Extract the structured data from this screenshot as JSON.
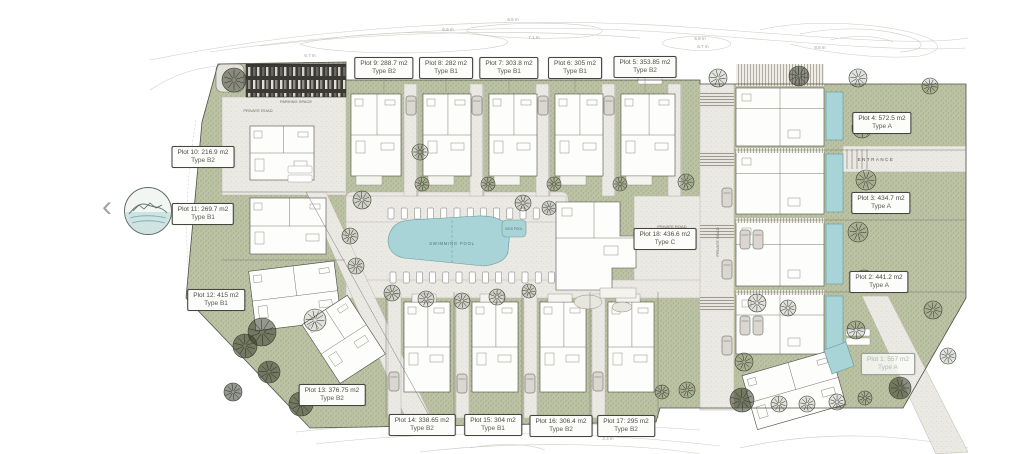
{
  "nav": {
    "back_icon": "‹"
  },
  "colors": {
    "green": "#bcc3a4",
    "road": "#ebe9e3",
    "pool": "#a8d4d7",
    "pool_edge": "#66979c",
    "line": "#4c4b45",
    "contour": "#cbcac4"
  },
  "plots": [
    {
      "id": 1,
      "area": "Plot 1: 557 m2",
      "type": "Type A"
    },
    {
      "id": 2,
      "area": "Plot 2: 441.2 m2",
      "type": "Type A"
    },
    {
      "id": 3,
      "area": "Plot 3: 434.7 m2",
      "type": "Type A"
    },
    {
      "id": 4,
      "area": "Plot 4: 572.5 m2",
      "type": "Type A"
    },
    {
      "id": 5,
      "area": "Plot 5: 353.85 m2",
      "type": "Type B2"
    },
    {
      "id": 6,
      "area": "Plot 6: 305 m2",
      "type": "Type B1"
    },
    {
      "id": 7,
      "area": "Plot 7: 303.8 m2",
      "type": "Type B1"
    },
    {
      "id": 8,
      "area": "Plot 8: 282 m2",
      "type": "Type B1"
    },
    {
      "id": 9,
      "area": "Plot 9: 288.7 m2",
      "type": "Type B2"
    },
    {
      "id": 10,
      "area": "Plot 10: 216.9 m2",
      "type": "Type B2"
    },
    {
      "id": 11,
      "area": "Plot 11: 269.7 m2",
      "type": "Type B1"
    },
    {
      "id": 12,
      "area": "Plot 12: 415 m2",
      "type": "Type B1"
    },
    {
      "id": 13,
      "area": "Plot 13: 376.75 m2",
      "type": "Type B2"
    },
    {
      "id": 14,
      "area": "Plot 14: 338.65 m2",
      "type": "Type B2"
    },
    {
      "id": 15,
      "area": "Plot 15: 304 m2",
      "type": "Type B1"
    },
    {
      "id": 16,
      "area": "Plot 16: 306.4 m2",
      "type": "Type B2"
    },
    {
      "id": 17,
      "area": "Plot 17: 295 m2",
      "type": "Type B2"
    },
    {
      "id": 18,
      "area": "Plot 18: 436.6 m2",
      "type": "Type C"
    }
  ],
  "map_labels": {
    "swimming_pool": "SWIMMING POOL",
    "kids_pool": "KIDS POOL",
    "private_road": "PRIVATE ROAD",
    "parking_space": "PARKING SPACE",
    "entrance": "ENTRANCE"
  },
  "contour_labels": [
    "6.5 m",
    "6.9 m",
    "7.1 m",
    "6.7 m",
    "6.8 m",
    "6.7 m",
    "8.6 m",
    "2.3 m"
  ]
}
